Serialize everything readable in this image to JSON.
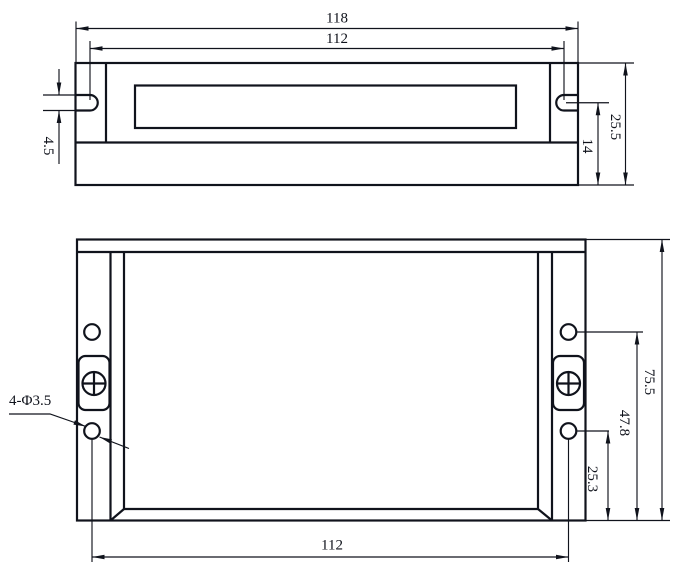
{
  "colors": {
    "background": "#ffffff",
    "line": "#10131c"
  },
  "drawing_type": "mechanical-dimension-drawing",
  "top_view": {
    "description": "side profile of driver enclosure",
    "dims": {
      "overall_width": "118",
      "slot_spacing": "112",
      "slot_width": "4.5",
      "slot_to_bottom": "14",
      "height": "25.5"
    }
  },
  "front_view": {
    "description": "front face of driver enclosure",
    "dims": {
      "hole_spacing": "112",
      "lower_hole_to_bottom": "25.3",
      "upper_hole_to_bottom": "47.8",
      "height": "75.5"
    },
    "hole_callout": "4-Φ3.5"
  }
}
